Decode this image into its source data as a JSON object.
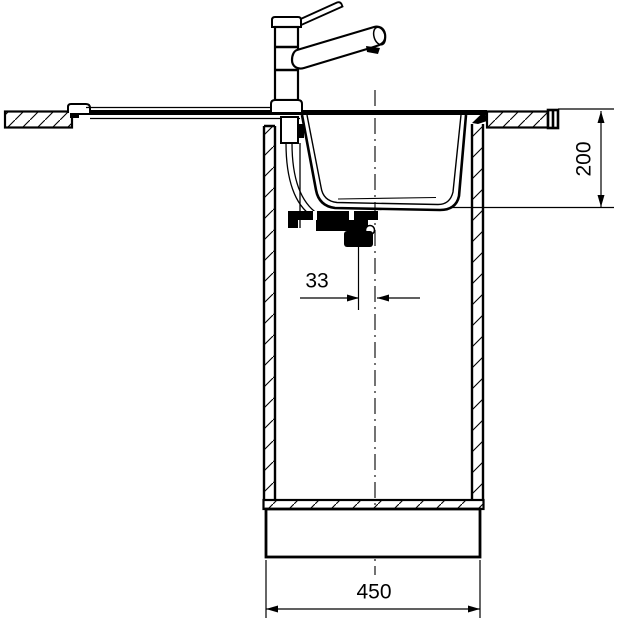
{
  "drawing": {
    "title": "sink-installation-section",
    "background": "#ffffff",
    "line_color": "#000000",
    "parts": [
      "faucet",
      "countertop",
      "sink-basin",
      "drain-assembly",
      "base-cabinet",
      "plinth",
      "centerline"
    ],
    "dimensions": [
      {
        "id": "bowl-depth",
        "label": "200",
        "orientation": "vertical",
        "location": "right"
      },
      {
        "id": "drain-offset",
        "label": "33",
        "orientation": "horizontal",
        "location": "center"
      },
      {
        "id": "cabinet-width",
        "label": "450",
        "orientation": "horizontal",
        "location": "bottom"
      }
    ]
  }
}
